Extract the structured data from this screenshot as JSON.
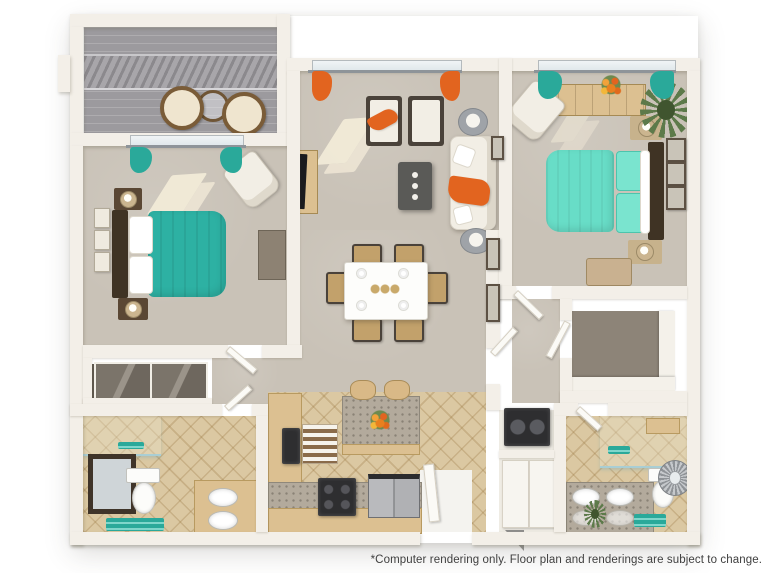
{
  "disclaimer": "*Computer rendering only. Floor plan and renderings are subject to change.",
  "palette": {
    "background": "#ffffff",
    "wall": "#f3efe8",
    "wall_shadow": "#d8d2c5",
    "carpet": "#c9c2b7",
    "tile": "#dbc8a2",
    "patio_floor": "#9c9a9e",
    "teal_bed": "#2db1a3",
    "mint_bed": "#68ddc7",
    "teal_accent": "#2aa99a",
    "orange_accent": "#e2641f",
    "rust_rug": "#b35332",
    "dark_rug": "#46372a",
    "dark_wood": "#4a3b2b",
    "tan_wood": "#dcc091",
    "granite": "#b3aa9c",
    "appliance_black": "#2e2e30",
    "white_fabric": "#f2eee5",
    "plant_green": "#5d7a4a",
    "text": "#3f3f3f"
  }
}
